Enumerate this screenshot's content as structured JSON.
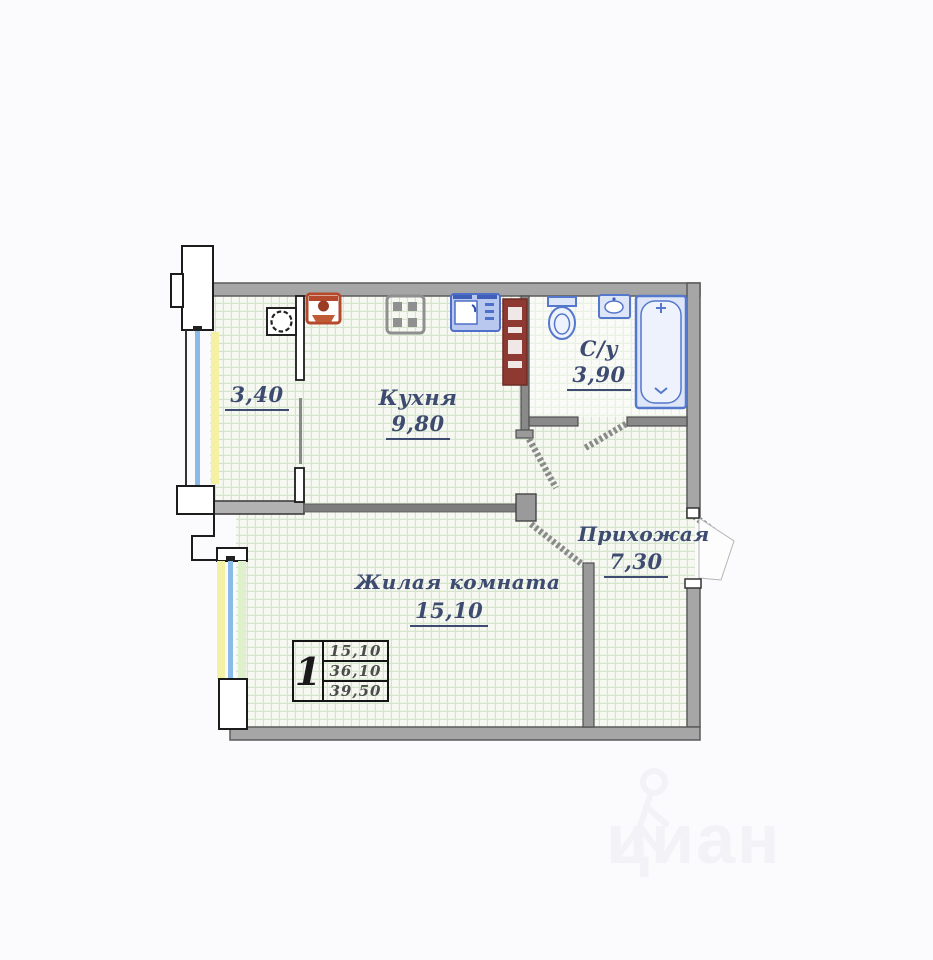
{
  "page": {
    "background": "#fbfafc"
  },
  "floorplan": {
    "rooms": {
      "balcony": {
        "area": "3,40"
      },
      "kitchen": {
        "name": "Кухня",
        "area": "9,80"
      },
      "bathroom": {
        "name": "С/у",
        "area": "3,90"
      },
      "hallway": {
        "name": "Прихожая",
        "area": "7,30"
      },
      "living_room": {
        "name": "Жилая комната",
        "area": "15,10"
      }
    },
    "info_table": {
      "rooms_count": "1",
      "rows": [
        "15,10",
        "36,10",
        "39,50"
      ]
    },
    "watermark": {
      "text": "циан"
    },
    "icons": [
      "washing-machine-icon",
      "stove-icon",
      "kitchen-sink-icon",
      "red-appliance-icon",
      "cabinet-column-icon",
      "toilet-icon",
      "washbasin-icon",
      "bathtub-icon",
      "person-walking-icon"
    ],
    "colors": {
      "wall_gray": "#a6a6a6",
      "thin_wall_gray": "#8a8a8a",
      "label_text": "#3d4b70",
      "floor_grid_line": "#d5e5cd",
      "plumbing_blue": "#5577cc",
      "appliance_red": "#b4492b",
      "cabinet_dark_red": "#8e3a32",
      "window_glass_blue": "#8abae8",
      "window_band_yellow": "#f4f0a4",
      "window_band_green": "#dff0cc"
    }
  }
}
